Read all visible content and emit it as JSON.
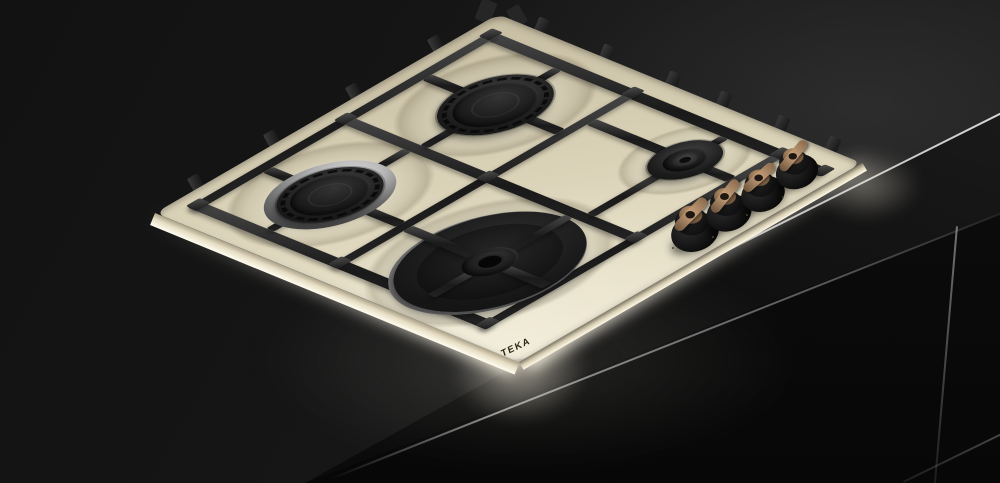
{
  "product": {
    "brand": "TEKA",
    "category": "gas hob, 4 burners, side controls",
    "finish": "vanilla cream enamel with cast-iron pan supports",
    "colors": {
      "hob_surface": "#e3dbc2",
      "pan_supports": "#1f1f1f",
      "burner_caps": "#151515",
      "chrome_burner_ring": "#b5b5b5",
      "knob_base": "#101010",
      "knob_handle_bronze": "#b08c64",
      "countertop": "#141414",
      "edge_highlight": "#cfcfcf"
    },
    "burners": [
      {
        "name": "semi-rapid burner back left"
      },
      {
        "name": "auxiliary burner back right"
      },
      {
        "name": "semi-rapid burner front left"
      },
      {
        "name": "rapid burner front center"
      }
    ],
    "controls": {
      "knob_count": 4,
      "style": "black knobs with bronze wing handles"
    }
  }
}
